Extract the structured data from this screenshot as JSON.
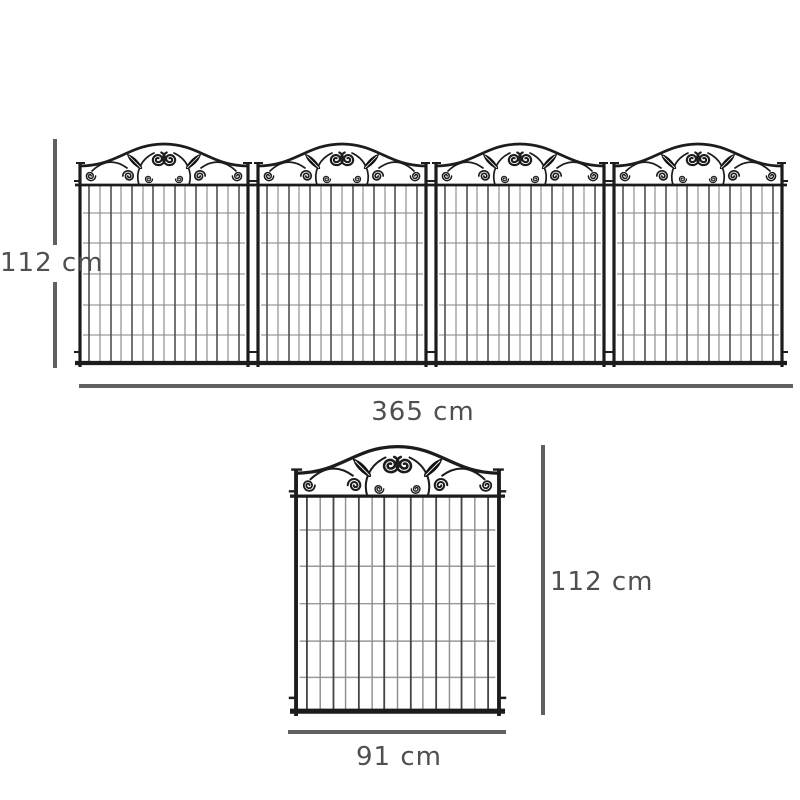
{
  "page": {
    "background": "#ffffff",
    "kind": "product dimension diagram",
    "subject": "decorative metal garden fence panels with scrollwork tops"
  },
  "colors": {
    "fence_frame": "#1c1c1c",
    "wire_dark": "#454545",
    "wire_light": "#8f8f8f",
    "grid_horizontal": "#9a9a9a",
    "leaf_fill": "#111111",
    "dimension_line": "#616161",
    "label_text": "#4f4f4f"
  },
  "top_assembly": {
    "description": "four fence panels connected in a row",
    "panel_count": 4,
    "height_label": "112 cm",
    "width_label": "365 cm"
  },
  "single_panel": {
    "description": "one fence panel",
    "panel_count": 1,
    "height_label": "112 cm",
    "width_label": "91 cm"
  },
  "labels": {
    "top_height": "112 cm",
    "top_width": "365 cm",
    "single_height": "112 cm",
    "single_width": "91 cm"
  }
}
